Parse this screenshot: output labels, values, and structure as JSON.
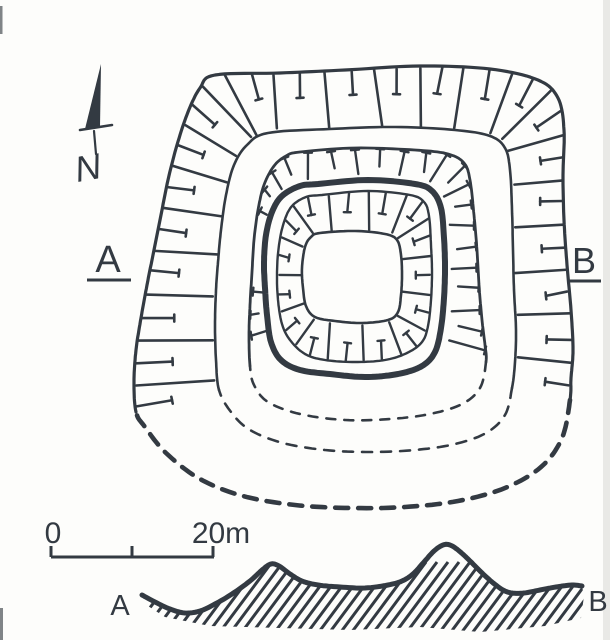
{
  "page": {
    "paper_color": "#fdfdfb",
    "ink_color": "#333a42"
  },
  "compass": {
    "label": "N",
    "icon": "north-arrow-icon"
  },
  "plan": {
    "description_icon": "hachured-square-earthwork-plan",
    "section_marker_left": "A",
    "section_marker_right": "B"
  },
  "scale_bar": {
    "start_label": "0",
    "end_label": "20m"
  },
  "section": {
    "left_label": "A",
    "right_label": "B"
  }
}
